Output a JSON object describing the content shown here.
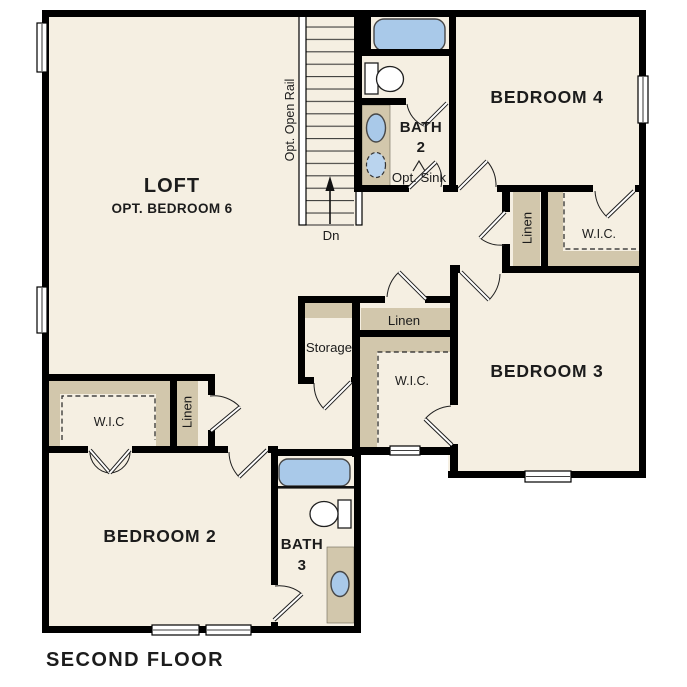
{
  "plan_title": "SECOND FLOOR",
  "colors": {
    "background": "#ffffff",
    "floor": "#f5efe2",
    "millwork": "#d2c7ac",
    "fixture": "#a9c9e9",
    "fixture_alt": "#bad4ee",
    "wall": "#000000",
    "ink": "#1c1c1c"
  },
  "rooms": {
    "loft": {
      "name": "LOFT",
      "option": "OPT. BEDROOM 6"
    },
    "bedroom_2": {
      "name": "BEDROOM 2"
    },
    "bedroom_3": {
      "name": "BEDROOM 3"
    },
    "bedroom_4": {
      "name": "BEDROOM 4"
    },
    "bath_2": {
      "name_line1": "BATH",
      "name_line2": "2",
      "option": "Opt. Sink"
    },
    "bath_3": {
      "name_line1": "BATH",
      "name_line2": "3"
    },
    "storage": {
      "name": "Storage"
    },
    "linen_hall": {
      "name": "Linen"
    },
    "linen_center": {
      "name": "Linen"
    },
    "linen_bedroom_2": {
      "name": "Linen"
    },
    "wic_bedroom_4": {
      "name": "W.I.C."
    },
    "wic_bedroom_3": {
      "name": "W.I.C."
    },
    "wic_bedroom_2": {
      "name": "W.I.C"
    }
  },
  "stairs": {
    "rail_label": "Opt. Open Rail",
    "down_label": "Dn"
  }
}
